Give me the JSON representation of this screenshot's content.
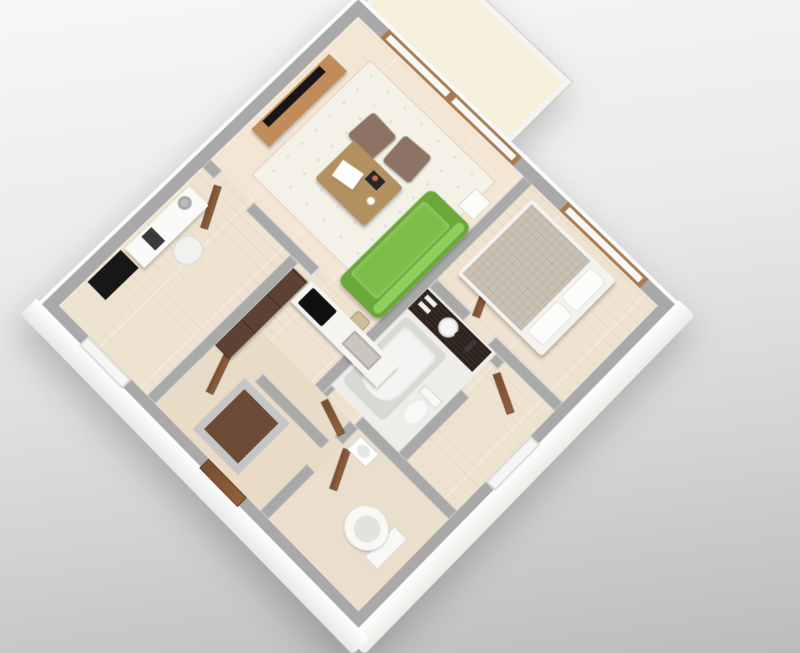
{
  "scene": {
    "title": "3D apartment floor plan render",
    "view": "isometric top-down, plan rotated 45 degrees",
    "background_top": "#f7f7f7",
    "background_bottom": "#bcbcbc"
  },
  "colors": {
    "bg-top": "#f7f7f7",
    "bg-bottom": "#bcbcbc",
    "wall": "#a9a9a9",
    "wall-face": "#fbfbfb",
    "floor-wood": "#eee2d0",
    "floor-hall": "#e8dcc6",
    "floor-bath": "#efedea",
    "floor-wc": "#eadfcd",
    "balcony-floor": "#f6efdb",
    "rug": "#f4f2e7",
    "sofa": "#7cbd47",
    "sofa-dark": "#69a839",
    "sofa-light": "#8fcf5c",
    "ottoman": "#8d7365",
    "table-wood": "#b3905f",
    "tv-board": "#c18c59",
    "tv-black": "#161616",
    "bed-frame": "#f3f2ee",
    "bed-mattress": "#c8c1b3",
    "pillow": "#fcfcfa",
    "door-wood": "#7a4e31",
    "window-frame": "#a87c52",
    "glass": "#f8f8f6",
    "vanity": "#2e231c",
    "sink": "#f5f5f3",
    "tub-rim": "#d8d8d4",
    "tub-inner": "#f4f4f2",
    "counter": "#f5f4f1",
    "cooktop": "#101010",
    "sink-steel": "#c9c6bf",
    "cabinet-wood": "#5d4233",
    "desk": "#fafaf8",
    "lamp": "#bdbdbd",
    "chair": "#f1f1ef",
    "cabinet-black": "#171717",
    "toilet": "#f8f8f6",
    "toilet-inner": "#e2e2de",
    "entry-closet-floor": "#6b4b36"
  },
  "rooms": [
    {
      "id": "living",
      "label": "Living room"
    },
    {
      "id": "balcony",
      "label": "Balcony"
    },
    {
      "id": "bedroom",
      "label": "Bedroom"
    },
    {
      "id": "closet",
      "label": "Walk-in closet"
    },
    {
      "id": "bathroom",
      "label": "Bathroom"
    },
    {
      "id": "kitchen",
      "label": "Kitchen"
    },
    {
      "id": "office",
      "label": "Home office"
    },
    {
      "id": "hallway",
      "label": "Hallway"
    },
    {
      "id": "wc",
      "label": "WC"
    },
    {
      "id": "entry",
      "label": "Entry"
    }
  ],
  "furniture": [
    {
      "room": "living",
      "name": "green sofa",
      "color": "#7cbd47"
    },
    {
      "room": "living",
      "name": "wood coffee table",
      "color": "#b3905f"
    },
    {
      "room": "living",
      "name": "ottoman",
      "color": "#8d7365"
    },
    {
      "room": "living",
      "name": "ottoman",
      "color": "#8d7365"
    },
    {
      "room": "living",
      "name": "tv sideboard",
      "color": "#c18c59"
    },
    {
      "room": "living",
      "name": "flat tv",
      "color": "#161616"
    },
    {
      "room": "living",
      "name": "area rug",
      "color": "#f4f2e7"
    },
    {
      "room": "living",
      "name": "side table",
      "color": "#fbfbf9"
    },
    {
      "room": "living",
      "name": "balcony sliding window",
      "color": "#a87c52"
    },
    {
      "room": "bedroom",
      "name": "double bed",
      "color": "#c8c1b3"
    },
    {
      "room": "bedroom",
      "name": "pillows",
      "color": "#fcfcfa"
    },
    {
      "room": "bedroom",
      "name": "window",
      "color": "#a87c52"
    },
    {
      "room": "bathroom",
      "name": "dark vanity with sink",
      "color": "#2e231c"
    },
    {
      "room": "bathroom",
      "name": "bathtub",
      "color": "#f4f4f2"
    },
    {
      "room": "bathroom",
      "name": "shower head",
      "color": "#3a3a3a"
    },
    {
      "room": "bathroom",
      "name": "toilet",
      "color": "#f8f8f6"
    },
    {
      "room": "kitchen",
      "name": "tall wood cabinet",
      "color": "#5d4233"
    },
    {
      "room": "kitchen",
      "name": "counter",
      "color": "#f5f4f1"
    },
    {
      "room": "kitchen",
      "name": "black cooktop",
      "color": "#101010"
    },
    {
      "room": "kitchen",
      "name": "steel sink",
      "color": "#c9c6bf"
    },
    {
      "room": "office",
      "name": "white desk",
      "color": "#fafaf8"
    },
    {
      "room": "office",
      "name": "desk lamp",
      "color": "#bdbdbd"
    },
    {
      "room": "office",
      "name": "desk chair",
      "color": "#f1f1ef"
    },
    {
      "room": "office",
      "name": "black cabinet",
      "color": "#171717"
    },
    {
      "room": "wc",
      "name": "toilet",
      "color": "#f8f8f6"
    },
    {
      "room": "hallway",
      "name": "washbasin",
      "color": "#ffffff"
    },
    {
      "room": "entry",
      "name": "entry closet",
      "color": "#6b4b36"
    },
    {
      "room": "entry",
      "name": "wood doors",
      "color": "#7a4e31"
    }
  ]
}
